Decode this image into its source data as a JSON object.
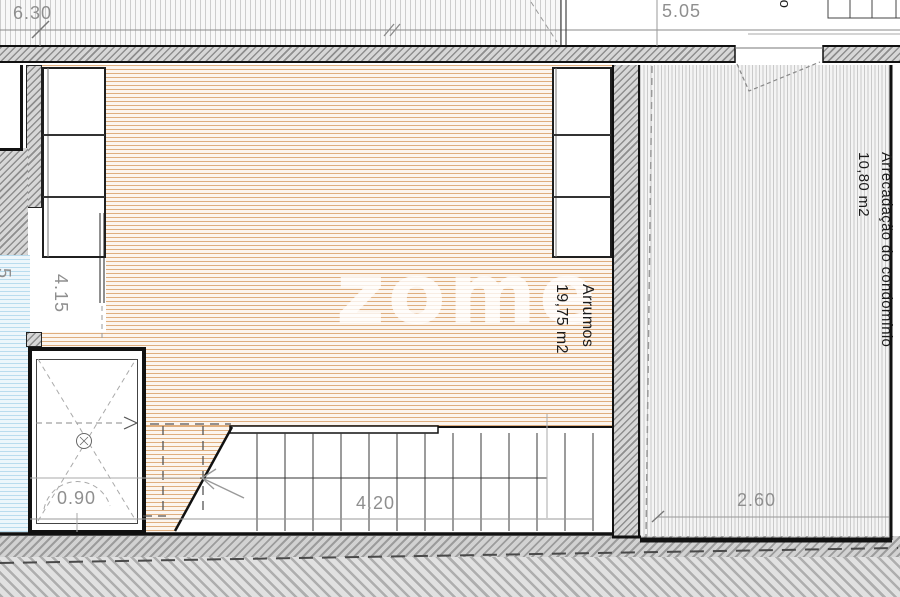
{
  "plan": {
    "watermark_text": "zome",
    "room_arrumos_name": "Arrumos",
    "room_arrumos_area": "19,75 m2",
    "room_storage_name": "Arrecadação do condomínio",
    "room_storage_area": "10,80 m2",
    "dim_top_left": "6.30",
    "dim_top_right": "5.05",
    "dim_left_vertical": "4.15",
    "dim_stair_width": "4.20",
    "dim_right_room_width": "2.60",
    "dim_shower_width": "0.90",
    "partial_label_top_right": "ão",
    "partial_dim_left_edge": "5",
    "colors": {
      "wood_hatch": "#dfae7e",
      "screed_hatch": "#c9c9c9",
      "bath_hatch": "#b9dcee",
      "wall_hatch": "#8e8e8e",
      "wall_line": "#141414",
      "dim_text": "#8f8f8f",
      "label_text": "#1b1b1b"
    }
  }
}
